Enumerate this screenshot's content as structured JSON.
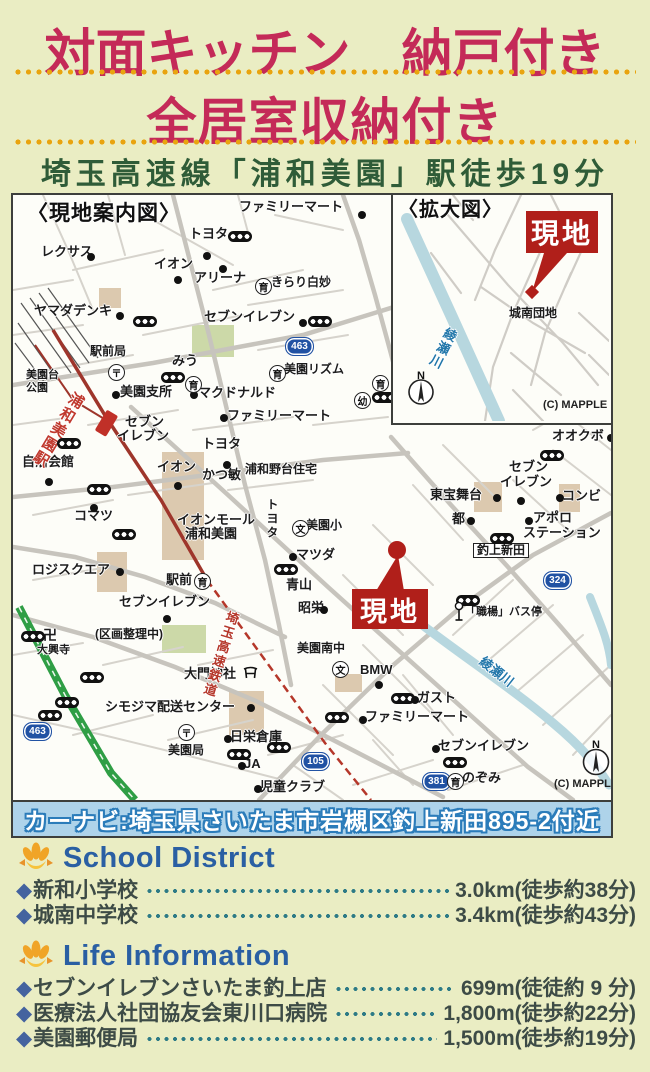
{
  "header": {
    "title_line1": "対面キッチン　納戸付き",
    "title_line2": "全居室収納付き",
    "subtitle": "埼玉高速線「浦和美園」駅徒歩19分"
  },
  "map": {
    "banner": "カーナビ:埼玉県さいたま市岩槻区釣上新田895-2付近",
    "genchi_label": "現地",
    "compass_n": "N",
    "labels": [
      {
        "t": "〈現地案内図〉",
        "x": 14,
        "y": 8,
        "s": 21,
        "c": "heading"
      },
      {
        "t": "ファミリーマート",
        "x": 226,
        "y": 5
      },
      {
        "t": "トヨタ",
        "x": 176,
        "y": 32
      },
      {
        "t": "レクサス",
        "x": 28,
        "y": 50
      },
      {
        "t": "イオン",
        "x": 141,
        "y": 62
      },
      {
        "t": "アリーナ",
        "x": 181,
        "y": 76
      },
      {
        "t": "きらり白妙",
        "x": 258,
        "y": 81,
        "s": 12
      },
      {
        "t": "ヤマダデンキ",
        "x": 21,
        "y": 109
      },
      {
        "t": "セブンイレブン",
        "x": 191,
        "y": 115
      },
      {
        "t": "駅前局",
        "x": 77,
        "y": 150,
        "s": 12
      },
      {
        "t": "みう",
        "x": 159,
        "y": 159
      },
      {
        "t": "美園台",
        "x": 13,
        "y": 175,
        "s": 11
      },
      {
        "t": "公園",
        "x": 13,
        "y": 188,
        "s": 11
      },
      {
        "t": "美園支所",
        "x": 107,
        "y": 190
      },
      {
        "t": "マクドナルド",
        "x": 185,
        "y": 191
      },
      {
        "t": "美園リズム",
        "x": 271,
        "y": 168,
        "s": 12
      },
      {
        "t": "ファミリーマート",
        "x": 214,
        "y": 214
      },
      {
        "t": "セブン",
        "x": 112,
        "y": 220
      },
      {
        "t": "イレブン",
        "x": 104,
        "y": 234
      },
      {
        "t": "トヨタ",
        "x": 189,
        "y": 242
      },
      {
        "t": "自治会館",
        "x": 9,
        "y": 260
      },
      {
        "t": "浦和美園駅",
        "x": 58,
        "y": 198,
        "s": 15,
        "c": "v red rot31"
      },
      {
        "t": "イオン",
        "x": 144,
        "y": 265
      },
      {
        "t": "かつ敏",
        "x": 189,
        "y": 273
      },
      {
        "t": "浦和野台住宅",
        "x": 232,
        "y": 268,
        "s": 12
      },
      {
        "t": "コマツ",
        "x": 61,
        "y": 314
      },
      {
        "t": "イオンモール",
        "x": 164,
        "y": 318
      },
      {
        "t": "浦和美園",
        "x": 172,
        "y": 332
      },
      {
        "t": "トヨタ",
        "x": 252,
        "y": 303,
        "s": 12,
        "c": "v"
      },
      {
        "t": "美園小",
        "x": 293,
        "y": 324,
        "s": 12
      },
      {
        "t": "マツダ",
        "x": 283,
        "y": 353
      },
      {
        "t": "青山",
        "x": 273,
        "y": 383
      },
      {
        "t": "昭栄",
        "x": 285,
        "y": 406
      },
      {
        "t": "ロジスクエア",
        "x": 19,
        "y": 368
      },
      {
        "t": "駅前",
        "x": 153,
        "y": 378
      },
      {
        "t": "セブンイレブン",
        "x": 106,
        "y": 400
      },
      {
        "t": "(区画整理中)",
        "x": 82,
        "y": 433,
        "s": 12
      },
      {
        "t": "卍",
        "x": 30,
        "y": 433,
        "s": 14
      },
      {
        "t": "大興寺",
        "x": 24,
        "y": 450,
        "s": 11
      },
      {
        "t": "大門神社",
        "x": 171,
        "y": 472
      },
      {
        "t": "シモジマ配送センター",
        "x": 92,
        "y": 505
      },
      {
        "t": "美園局",
        "x": 155,
        "y": 549,
        "s": 12
      },
      {
        "t": "日栄倉庫",
        "x": 217,
        "y": 535
      },
      {
        "t": "JA",
        "x": 231,
        "y": 562
      },
      {
        "t": "児童クラブ",
        "x": 247,
        "y": 585
      },
      {
        "t": "埼玉高速鉄道",
        "x": 213,
        "y": 416,
        "s": 13,
        "c": "v red2 rot17"
      },
      {
        "t": "オオクボ",
        "x": 539,
        "y": 234
      },
      {
        "t": "セブン",
        "x": 496,
        "y": 265
      },
      {
        "t": "イレブン",
        "x": 487,
        "y": 280
      },
      {
        "t": "コンビ",
        "x": 549,
        "y": 294
      },
      {
        "t": "東宝舞台",
        "x": 417,
        "y": 293
      },
      {
        "t": "都",
        "x": 439,
        "y": 317
      },
      {
        "t": "アポロ",
        "x": 520,
        "y": 316
      },
      {
        "t": "ステーション",
        "x": 510,
        "y": 331
      },
      {
        "t": "釣上新田",
        "x": 460,
        "y": 348,
        "s": 12,
        "c": "boxed"
      },
      {
        "t": "「職楊」バス停",
        "x": 452,
        "y": 412,
        "s": 11
      },
      {
        "t": "美園南中",
        "x": 284,
        "y": 447,
        "s": 12
      },
      {
        "t": "BMW",
        "x": 347,
        "y": 468
      },
      {
        "t": "ガスト",
        "x": 404,
        "y": 496
      },
      {
        "t": "ファミリーマート",
        "x": 352,
        "y": 515
      },
      {
        "t": "セブンイレブン",
        "x": 425,
        "y": 544
      },
      {
        "t": "のぞみ",
        "x": 449,
        "y": 576
      },
      {
        "t": "(C) MAPPLE",
        "x": 541,
        "y": 584,
        "s": 11,
        "c": "copyright"
      },
      {
        "t": "綾瀬川",
        "x": 468,
        "y": 458,
        "s": 13,
        "c": "rot38 blue"
      }
    ],
    "icons": [
      {
        "k": "signal",
        "x": 215,
        "y": 36
      },
      {
        "k": "signal",
        "x": 120,
        "y": 121
      },
      {
        "k": "signal",
        "x": 295,
        "y": 121
      },
      {
        "k": "signal",
        "x": 148,
        "y": 177
      },
      {
        "k": "signal",
        "x": 44,
        "y": 243
      },
      {
        "k": "signal",
        "x": 74,
        "y": 289
      },
      {
        "k": "signal",
        "x": 99,
        "y": 334
      },
      {
        "k": "signal",
        "x": 261,
        "y": 369
      },
      {
        "k": "signal",
        "x": 8,
        "y": 436
      },
      {
        "k": "signal",
        "x": 67,
        "y": 477
      },
      {
        "k": "signal",
        "x": 42,
        "y": 502
      },
      {
        "k": "signal",
        "x": 25,
        "y": 515
      },
      {
        "k": "signal",
        "x": 214,
        "y": 554
      },
      {
        "k": "signal",
        "x": 254,
        "y": 547
      },
      {
        "k": "signal",
        "x": 527,
        "y": 255
      },
      {
        "k": "signal",
        "x": 477,
        "y": 338
      },
      {
        "k": "signal",
        "x": 443,
        "y": 400
      },
      {
        "k": "signal",
        "x": 378,
        "y": 498
      },
      {
        "k": "signal",
        "x": 312,
        "y": 517
      },
      {
        "k": "signal",
        "x": 430,
        "y": 562
      },
      {
        "k": "signal",
        "x": 359,
        "y": 197
      },
      {
        "k": "dot",
        "x": 345,
        "y": 16
      },
      {
        "k": "dot",
        "x": 190,
        "y": 57
      },
      {
        "k": "dot",
        "x": 74,
        "y": 58
      },
      {
        "k": "dot",
        "x": 161,
        "y": 81
      },
      {
        "k": "dot",
        "x": 206,
        "y": 70
      },
      {
        "k": "dot",
        "x": 103,
        "y": 117
      },
      {
        "k": "dot",
        "x": 286,
        "y": 124
      },
      {
        "k": "dot",
        "x": 177,
        "y": 196
      },
      {
        "k": "dot",
        "x": 99,
        "y": 196
      },
      {
        "k": "dot",
        "x": 207,
        "y": 219
      },
      {
        "k": "dot",
        "x": 210,
        "y": 266
      },
      {
        "k": "dot",
        "x": 32,
        "y": 283
      },
      {
        "k": "dot",
        "x": 161,
        "y": 287
      },
      {
        "k": "dot",
        "x": 77,
        "y": 309
      },
      {
        "k": "dot",
        "x": 276,
        "y": 358
      },
      {
        "k": "dot",
        "x": 307,
        "y": 411
      },
      {
        "k": "dot",
        "x": 103,
        "y": 373
      },
      {
        "k": "dot",
        "x": 150,
        "y": 420
      },
      {
        "k": "dot",
        "x": 234,
        "y": 509
      },
      {
        "k": "dot",
        "x": 211,
        "y": 540
      },
      {
        "k": "dot",
        "x": 225,
        "y": 567
      },
      {
        "k": "dot",
        "x": 241,
        "y": 590
      },
      {
        "k": "dot",
        "x": 594,
        "y": 239
      },
      {
        "k": "dot",
        "x": 504,
        "y": 302
      },
      {
        "k": "dot",
        "x": 543,
        "y": 299
      },
      {
        "k": "dot",
        "x": 480,
        "y": 299
      },
      {
        "k": "dot",
        "x": 454,
        "y": 322
      },
      {
        "k": "dot",
        "x": 512,
        "y": 322
      },
      {
        "k": "dot",
        "x": 362,
        "y": 486
      },
      {
        "k": "dot",
        "x": 398,
        "y": 501
      },
      {
        "k": "dot",
        "x": 346,
        "y": 521
      },
      {
        "k": "dot",
        "x": 419,
        "y": 550
      },
      {
        "k": "shield",
        "x": 272,
        "y": 142,
        "v": "463"
      },
      {
        "k": "shield",
        "x": 10,
        "y": 527,
        "v": "463"
      },
      {
        "k": "shield",
        "x": 288,
        "y": 557,
        "v": "105"
      },
      {
        "k": "shield",
        "x": 530,
        "y": 376,
        "v": "324"
      },
      {
        "k": "shield",
        "x": 409,
        "y": 577,
        "v": "381"
      },
      {
        "k": "circle",
        "x": 242,
        "y": 83,
        "v": "育"
      },
      {
        "k": "circle",
        "x": 172,
        "y": 181,
        "v": "育"
      },
      {
        "k": "circle",
        "x": 256,
        "y": 170,
        "v": "育"
      },
      {
        "k": "circle",
        "x": 181,
        "y": 378,
        "v": "育"
      },
      {
        "k": "circle",
        "x": 434,
        "y": 578,
        "v": "育"
      },
      {
        "k": "circle",
        "x": 359,
        "y": 180,
        "v": "育"
      },
      {
        "k": "circle",
        "x": 341,
        "y": 197,
        "v": "幼"
      },
      {
        "k": "circle",
        "x": 279,
        "y": 325,
        "v": "文"
      },
      {
        "k": "circle",
        "x": 319,
        "y": 466,
        "v": "文"
      },
      {
        "k": "circle",
        "x": 95,
        "y": 169,
        "v": "〒"
      },
      {
        "k": "circle",
        "x": 165,
        "y": 529,
        "v": "〒"
      }
    ],
    "inset_labels": [
      {
        "t": "〈拡大図〉",
        "x": 5,
        "y": 5,
        "s": 20,
        "c": "heading"
      },
      {
        "t": "城南団地",
        "x": 116,
        "y": 112,
        "s": 12
      },
      {
        "t": "(C) MAPPLE",
        "x": 150,
        "y": 205,
        "s": 11,
        "c": "copyright"
      },
      {
        "t": "綾瀬川",
        "x": 52,
        "y": 133,
        "s": 13,
        "c": "v blue rot27"
      }
    ]
  },
  "sections": [
    {
      "title": "School District",
      "items": [
        {
          "name": "新和小学校",
          "value": "3.0km(徒歩約38分)"
        },
        {
          "name": "城南中学校",
          "value": "3.4km(徒歩約43分)"
        }
      ]
    },
    {
      "title": "Life Information",
      "items": [
        {
          "name": "セブンイレブンさいたま釣上店",
          "value": "699m(徒徒約 9 分)"
        },
        {
          "name": "医療法人社団協友会東川口病院",
          "value": "1,800m(徒歩約22分)"
        },
        {
          "name": "美園郵便局",
          "value": "1,500m(徒歩約19分)"
        }
      ]
    }
  ]
}
